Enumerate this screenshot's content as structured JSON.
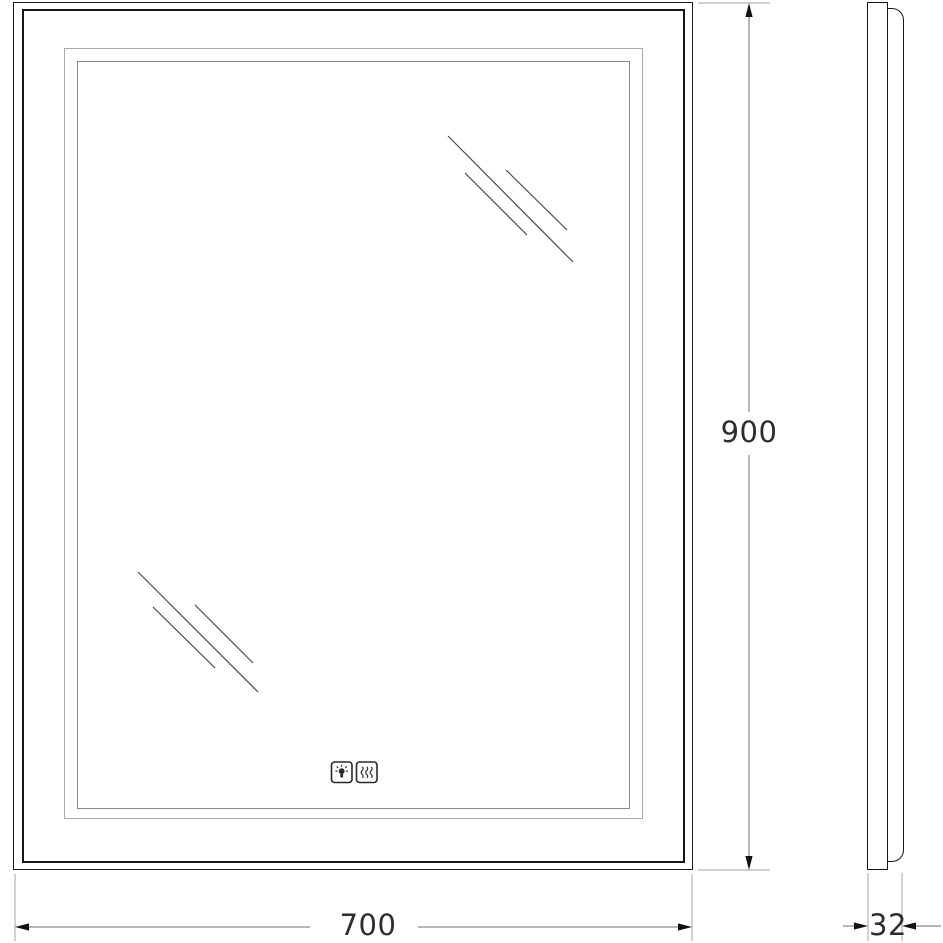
{
  "meta": {
    "type": "technical-drawing",
    "subject": "rectangular LED mirror, front elevation and side profile"
  },
  "front_view": {
    "height_dim": {
      "value": "900"
    },
    "width_dim": {
      "value": "700"
    }
  },
  "side_view": {
    "depth_dim": {
      "value": "32"
    }
  },
  "icons": {
    "light": "touch-light-sensor-icon",
    "heat": "anti-fog-heater-icon"
  },
  "colors": {
    "background": "#ffffff",
    "frame_dark": "#1c1c1c",
    "led_frame_light": "#ababab",
    "led_frame_gray": "#8a8a8a",
    "extension_line": "#b5b5b5",
    "dimension_line": "#6e6e6e",
    "reflection_line": "#4a4a4a",
    "text": "#2e2e2e"
  }
}
